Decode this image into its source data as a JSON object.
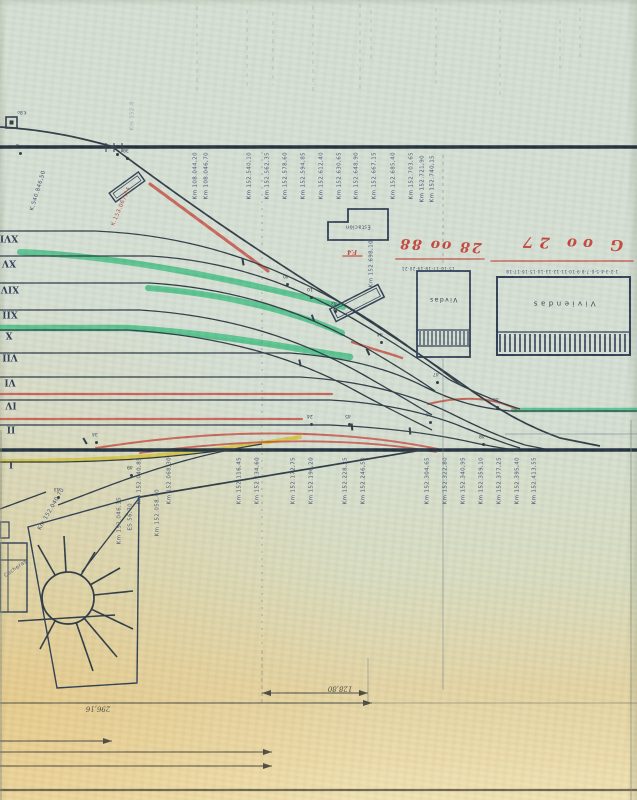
{
  "document": {
    "kind": "scanned railway station track layout plan, scan inverted 180 degrees",
    "language": "Spanish"
  },
  "colors": {
    "paper": "#d6dfd3",
    "paper_warm": "#ecdbaa",
    "ink": "#2e3b46",
    "ink_heavy": "#22313d",
    "blue_label": "#3b4a70",
    "green": "#2cb876",
    "red": "#c4473c",
    "yellow": "#d3c23a",
    "building": "#2f3e55"
  },
  "track_labels": [
    {
      "n": "XVI",
      "x": 9,
      "y": 237
    },
    {
      "n": "XV",
      "x": 9,
      "y": 262
    },
    {
      "n": "XIV",
      "x": 10,
      "y": 288
    },
    {
      "n": "XII",
      "x": 10,
      "y": 313
    },
    {
      "n": "X",
      "x": 9,
      "y": 334
    },
    {
      "n": "VII",
      "x": 10,
      "y": 356
    },
    {
      "n": "VI",
      "x": 10,
      "y": 381
    },
    {
      "n": "IV",
      "x": 11,
      "y": 404
    },
    {
      "n": "II",
      "x": 11,
      "y": 428
    },
    {
      "n": "I",
      "x": 11,
      "y": 463
    }
  ],
  "km_labels_top": [
    {
      "text": "Km 108.044,20",
      "x": 196,
      "y": 152
    },
    {
      "text": "Km 108.046,70",
      "x": 207,
      "y": 152
    },
    {
      "text": "Km 152.540,10",
      "x": 250,
      "y": 152
    },
    {
      "text": "Km 152.562,35",
      "x": 268,
      "y": 152
    },
    {
      "text": "Km 152.578,60",
      "x": 286,
      "y": 152
    },
    {
      "text": "Km 152.594,85",
      "x": 304,
      "y": 152
    },
    {
      "text": "Km 152.612,40",
      "x": 322,
      "y": 152
    },
    {
      "text": "Km 152.630,65",
      "x": 340,
      "y": 152
    },
    {
      "text": "Km 152.648,90",
      "x": 357,
      "y": 152
    },
    {
      "text": "Km 152.667,15",
      "x": 375,
      "y": 152
    },
    {
      "text": "Km 152.685,40",
      "x": 394,
      "y": 152
    },
    {
      "text": "Km 152.703,65",
      "x": 412,
      "y": 152
    },
    {
      "text": "Km 152.721,90",
      "x": 423,
      "y": 155
    },
    {
      "text": "Km 152.740,15",
      "x": 433,
      "y": 155
    }
  ],
  "km_labels_bottom": [
    {
      "text": "Km 152.040,85",
      "x": 140,
      "y": 457
    },
    {
      "text": "Km 152.068,30",
      "x": 170,
      "y": 457
    },
    {
      "text": "Km 152.116,45",
      "x": 240,
      "y": 457
    },
    {
      "text": "Km 152.134,60",
      "x": 258,
      "y": 457
    },
    {
      "text": "Km 152.172,75",
      "x": 294,
      "y": 457
    },
    {
      "text": "Km 152.190,20",
      "x": 312,
      "y": 457
    },
    {
      "text": "Km 152.228,35",
      "x": 346,
      "y": 457
    },
    {
      "text": "Km 152.246,50",
      "x": 364,
      "y": 457
    },
    {
      "text": "Km 152.304,65",
      "x": 428,
      "y": 457
    },
    {
      "text": "Km 152.322,80",
      "x": 446,
      "y": 457
    },
    {
      "text": "Km 152.340,95",
      "x": 464,
      "y": 457
    },
    {
      "text": "Km 152.359,10",
      "x": 482,
      "y": 457
    },
    {
      "text": "Km 152.377,25",
      "x": 500,
      "y": 457
    },
    {
      "text": "Km 152.395,40",
      "x": 518,
      "y": 457
    },
    {
      "text": "Km 152.413,55",
      "x": 535,
      "y": 457
    }
  ],
  "km_labels_other": [
    {
      "text": "Km 152.8",
      "x": 133,
      "y": 101,
      "c": "#8b98ad",
      "op": 0.7
    },
    {
      "text": "Km 152.698,10",
      "x": 372,
      "y": 240
    },
    {
      "text": "K.540.846,50",
      "x": 39,
      "y": 170,
      "rot": 197
    },
    {
      "text": "K.153.067,54",
      "x": 122,
      "y": 186,
      "rot": 203,
      "c": "#b5463c"
    },
    {
      "text": "Km 152.046,15",
      "x": 120,
      "y": 497
    },
    {
      "text": "ES 56,70",
      "x": 131,
      "y": 503
    },
    {
      "text": "Km 152.058,40",
      "x": 158,
      "y": 489
    },
    {
      "text": "Km 152.040,70",
      "x": 52,
      "y": 486,
      "rot": 210
    },
    {
      "text": "Cocheras",
      "x": 16,
      "y": 556,
      "rot": 235,
      "size": 5
    }
  ],
  "switch_markers": [
    {
      "n": "4",
      "x": 20,
      "y": 153
    },
    {
      "n": "36",
      "x": 117,
      "y": 154
    },
    {
      "n": "38",
      "x": 127,
      "y": 158
    },
    {
      "n": "40",
      "x": 287,
      "y": 284
    },
    {
      "n": "10",
      "x": 311,
      "y": 297
    },
    {
      "n": "42",
      "x": 335,
      "y": 311
    },
    {
      "n": "44",
      "x": 381,
      "y": 342
    },
    {
      "n": "47",
      "x": 437,
      "y": 382
    },
    {
      "n": "46",
      "x": 497,
      "y": 407
    },
    {
      "n": "44",
      "x": 430,
      "y": 422
    },
    {
      "n": "48",
      "x": 483,
      "y": 444
    },
    {
      "n": "24",
      "x": 311,
      "y": 424
    },
    {
      "n": "45",
      "x": 349,
      "y": 424
    },
    {
      "n": "34",
      "x": 96,
      "y": 442
    },
    {
      "n": "49",
      "x": 131,
      "y": 475
    },
    {
      "n": "43",
      "x": 58,
      "y": 497
    }
  ],
  "red_annotations": [
    {
      "text": "28 oo 88",
      "x": 440,
      "y": 245,
      "size": 14,
      "rot": 183,
      "ls": 2
    },
    {
      "text": "G oo 27",
      "x": 570,
      "y": 243,
      "size": 15,
      "rot": 182,
      "ls": 6
    },
    {
      "text": "F.4",
      "x": 352,
      "y": 251,
      "size": 6,
      "rot": 180
    }
  ],
  "building_labels": [
    {
      "text": "Viviendas",
      "x": 563,
      "y": 303,
      "size": 7,
      "ls": 3.5
    },
    {
      "text": "Vivdas",
      "x": 443,
      "y": 299,
      "size": 6,
      "ls": 1.5
    },
    {
      "text": "Estación",
      "x": 358,
      "y": 226,
      "size": 5,
      "ls": 0.5
    }
  ],
  "dimension_labels": [
    {
      "text": "296,16",
      "x": 98,
      "y": 708,
      "size": 7
    },
    {
      "text": "128,80",
      "x": 340,
      "y": 688,
      "size": 7
    }
  ],
  "tiny_marks": [
    {
      "text": "15·16·17·18·19·20·21",
      "x": 428,
      "y": 268,
      "size": 4,
      "ls": 0.5
    },
    {
      "text": "1·2·3·4·5·6·7·8·9·10·11·12·13·14·15·16·17·18",
      "x": 562,
      "y": 271,
      "size": 4,
      "ls": 0.5
    },
    {
      "text": "K.Bo",
      "x": 22,
      "y": 112,
      "size": 4
    }
  ]
}
